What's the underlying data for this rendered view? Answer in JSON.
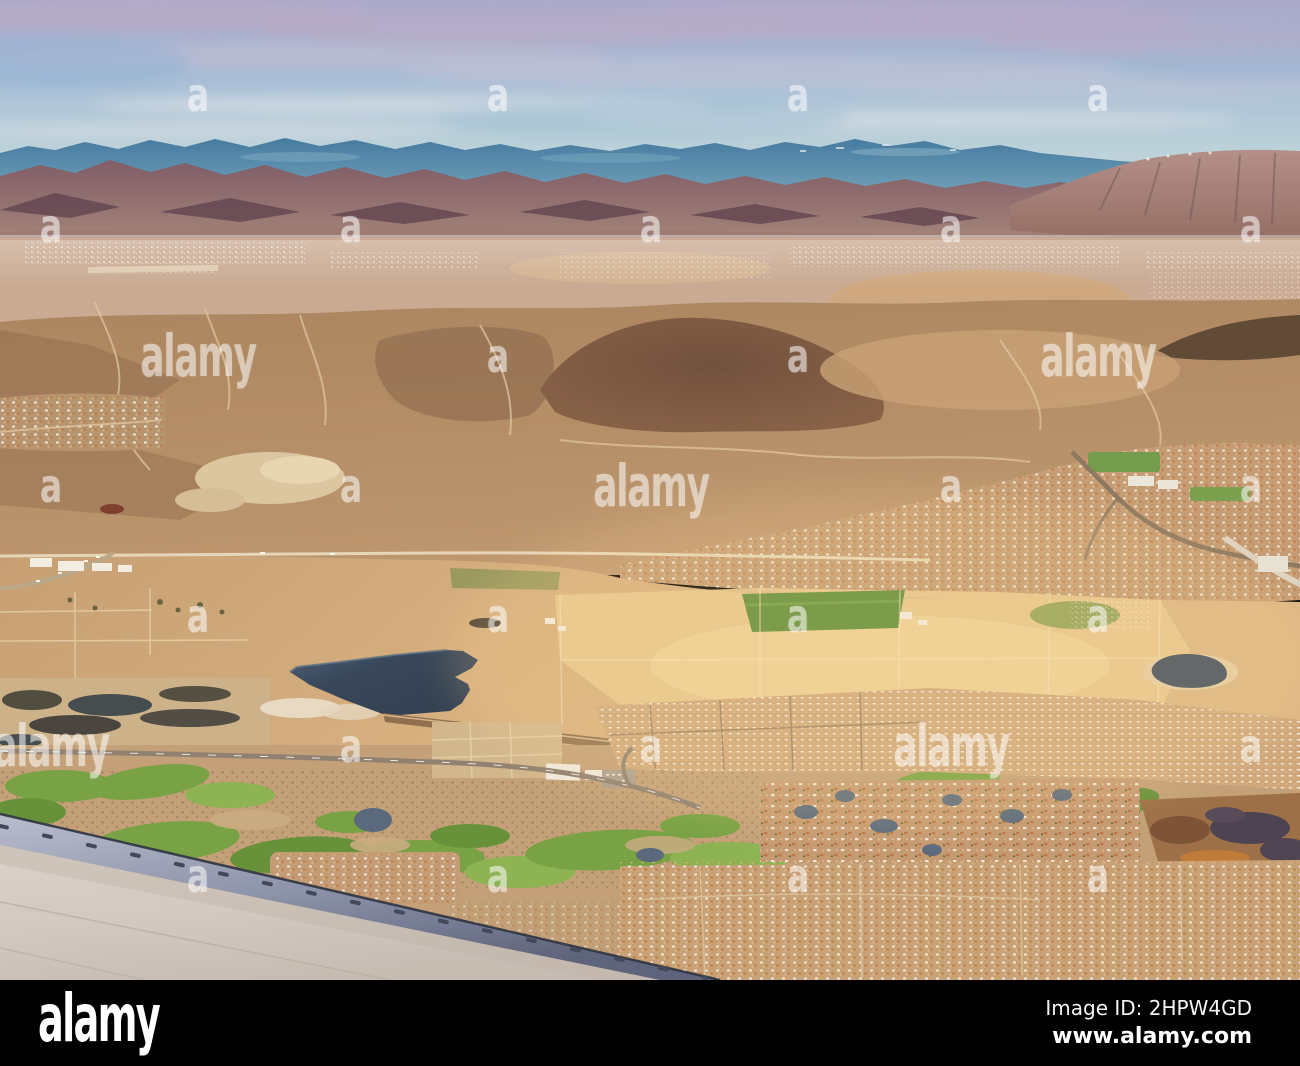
{
  "meta": {
    "kind": "watermarked stock photo preview",
    "description": "Aerial view from an airplane window over a Nevada desert valley with distant blue mountains, brown hills, suburban housing tracts, golden fields, a dark reservoir, green golf courses and the aircraft wing in the lower left corner"
  },
  "watermark": {
    "brand_text": "alamy",
    "tile_letter": "a",
    "color": "#ffffff",
    "opacity": 0.55,
    "small_marks": [
      [
        198,
        95
      ],
      [
        498,
        95
      ],
      [
        798,
        95
      ],
      [
        1098,
        95
      ],
      [
        51,
        226
      ],
      [
        351,
        226
      ],
      [
        651,
        226
      ],
      [
        951,
        226
      ],
      [
        1251,
        226
      ],
      [
        498,
        356
      ],
      [
        798,
        356
      ],
      [
        51,
        486
      ],
      [
        351,
        486
      ],
      [
        951,
        486
      ],
      [
        1251,
        486
      ],
      [
        198,
        616
      ],
      [
        498,
        616
      ],
      [
        798,
        616
      ],
      [
        1098,
        616
      ],
      [
        351,
        746
      ],
      [
        651,
        746
      ],
      [
        1251,
        746
      ],
      [
        198,
        876
      ],
      [
        498,
        876
      ],
      [
        798,
        876
      ],
      [
        1098,
        876
      ]
    ],
    "large_marks": [
      [
        198,
        356
      ],
      [
        1098,
        356
      ],
      [
        651,
        486
      ],
      [
        51,
        746
      ],
      [
        951,
        746
      ]
    ]
  },
  "footer": {
    "background": "#000000",
    "text_color": "#ffffff",
    "logo_text": "alamy",
    "image_id_text": "Image ID: 2HPW4GD",
    "website_text": "www.alamy.com"
  },
  "scene": {
    "palette": {
      "sky_top": "#a9a9cf",
      "sky_mid": "#a3bddb",
      "sky_low": "#cadbe0",
      "cloud_mauve": "#b5abca",
      "cloud_white": "#e6e9ee",
      "mtn_teal": "#3f7aa3",
      "mtn_teal_light": "#7fb0c5",
      "mtn_purple": "#7c5a68",
      "mtn_purple_lt": "#a8897c",
      "mtn_purple_dark": "#5e4150",
      "mtn_pink": "#b2908a",
      "valley_tan": "#c9ab94",
      "desert_tan": "#a9855f",
      "desert_tan_lt": "#bd9770",
      "desert_dark": "#6e4f3c",
      "desert_light": "#dcc8a3",
      "gold_base": "#d6b080",
      "gold_field": "#e9c98f",
      "ag_green": "#5b8f39",
      "water_dark": "#32445a",
      "water_pond": "#55687c",
      "golf_green": "#74a343",
      "golf_green_lt": "#8ab553",
      "housing_base": "#c49d74",
      "roof_orange": "#c07a4c",
      "roof_white": "#f4f0e7",
      "marsh_brown": "#9c6f46",
      "wing_gray": "#d3ccc5",
      "wing_edge_lt": "#b8bfd2",
      "wing_edge_dk": "#59627c",
      "glow": "#ffdf9a"
    }
  }
}
